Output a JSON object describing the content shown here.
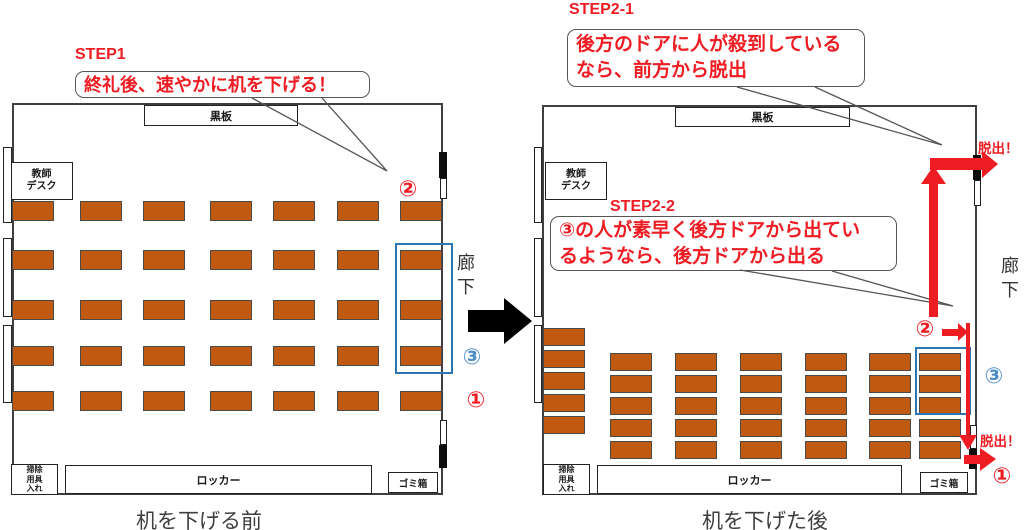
{
  "colors": {
    "desk_fill": "#C05A11",
    "red_accent": "#EE1C23",
    "blue_rect": "#2E75B6",
    "blue_marker": "#4D8BC9",
    "black_arrow": "#000000"
  },
  "left": {
    "step_title": "STEP1",
    "bubble": "終礼後、速やかに机を下げる！",
    "blackboard": "黒板",
    "teacher_desk_line1": "教師",
    "teacher_desk_line2": "デスク",
    "corridor": "廊下",
    "locker": "ロッカー",
    "cleaning_line1": "掃除",
    "cleaning_line2": "用具",
    "cleaning_line3": "入れ",
    "trash": "ゴミ箱",
    "caption": "机を下げる前",
    "marker_front": "②",
    "marker_middle": "③",
    "marker_rear": "①"
  },
  "right": {
    "step1_title": "STEP2-1",
    "bubble1_line1": "後方のドアに人が殺到している",
    "bubble1_line2": "なら、前方から脱出",
    "step2_title": "STEP2-2",
    "bubble2_line1": "③の人が素早く後方ドアから出てい",
    "bubble2_line2": "るようなら、後方ドアから出る",
    "blackboard": "黒板",
    "teacher_desk_line1": "教師",
    "teacher_desk_line2": "デスク",
    "corridor": "廊下",
    "locker": "ロッカー",
    "cleaning_line1": "掃除",
    "cleaning_line2": "用具",
    "cleaning_line3": "入れ",
    "trash": "ゴミ箱",
    "caption": "机を下げた後",
    "escape_top": "脱出！",
    "escape_bottom": "脱出！",
    "marker_front": "②",
    "marker_middle": "③",
    "marker_rear": "①"
  },
  "desk_groups": [
    {
      "name": "left-room-desks",
      "x_positions": [
        12,
        80,
        143,
        210,
        273,
        337,
        400
      ],
      "y_positions": [
        201,
        250,
        300,
        346,
        391
      ],
      "w": 42,
      "h": 20
    },
    {
      "name": "right-room-window-column",
      "x_positions": [
        543
      ],
      "y_positions": [
        328,
        350,
        372,
        394,
        416
      ],
      "w": 42,
      "h": 18
    },
    {
      "name": "right-room-packed-desks",
      "x_positions": [
        610,
        675,
        740,
        805,
        869,
        919
      ],
      "y_positions": [
        353,
        375,
        397,
        419,
        441
      ],
      "w": 42,
      "h": 18
    }
  ]
}
